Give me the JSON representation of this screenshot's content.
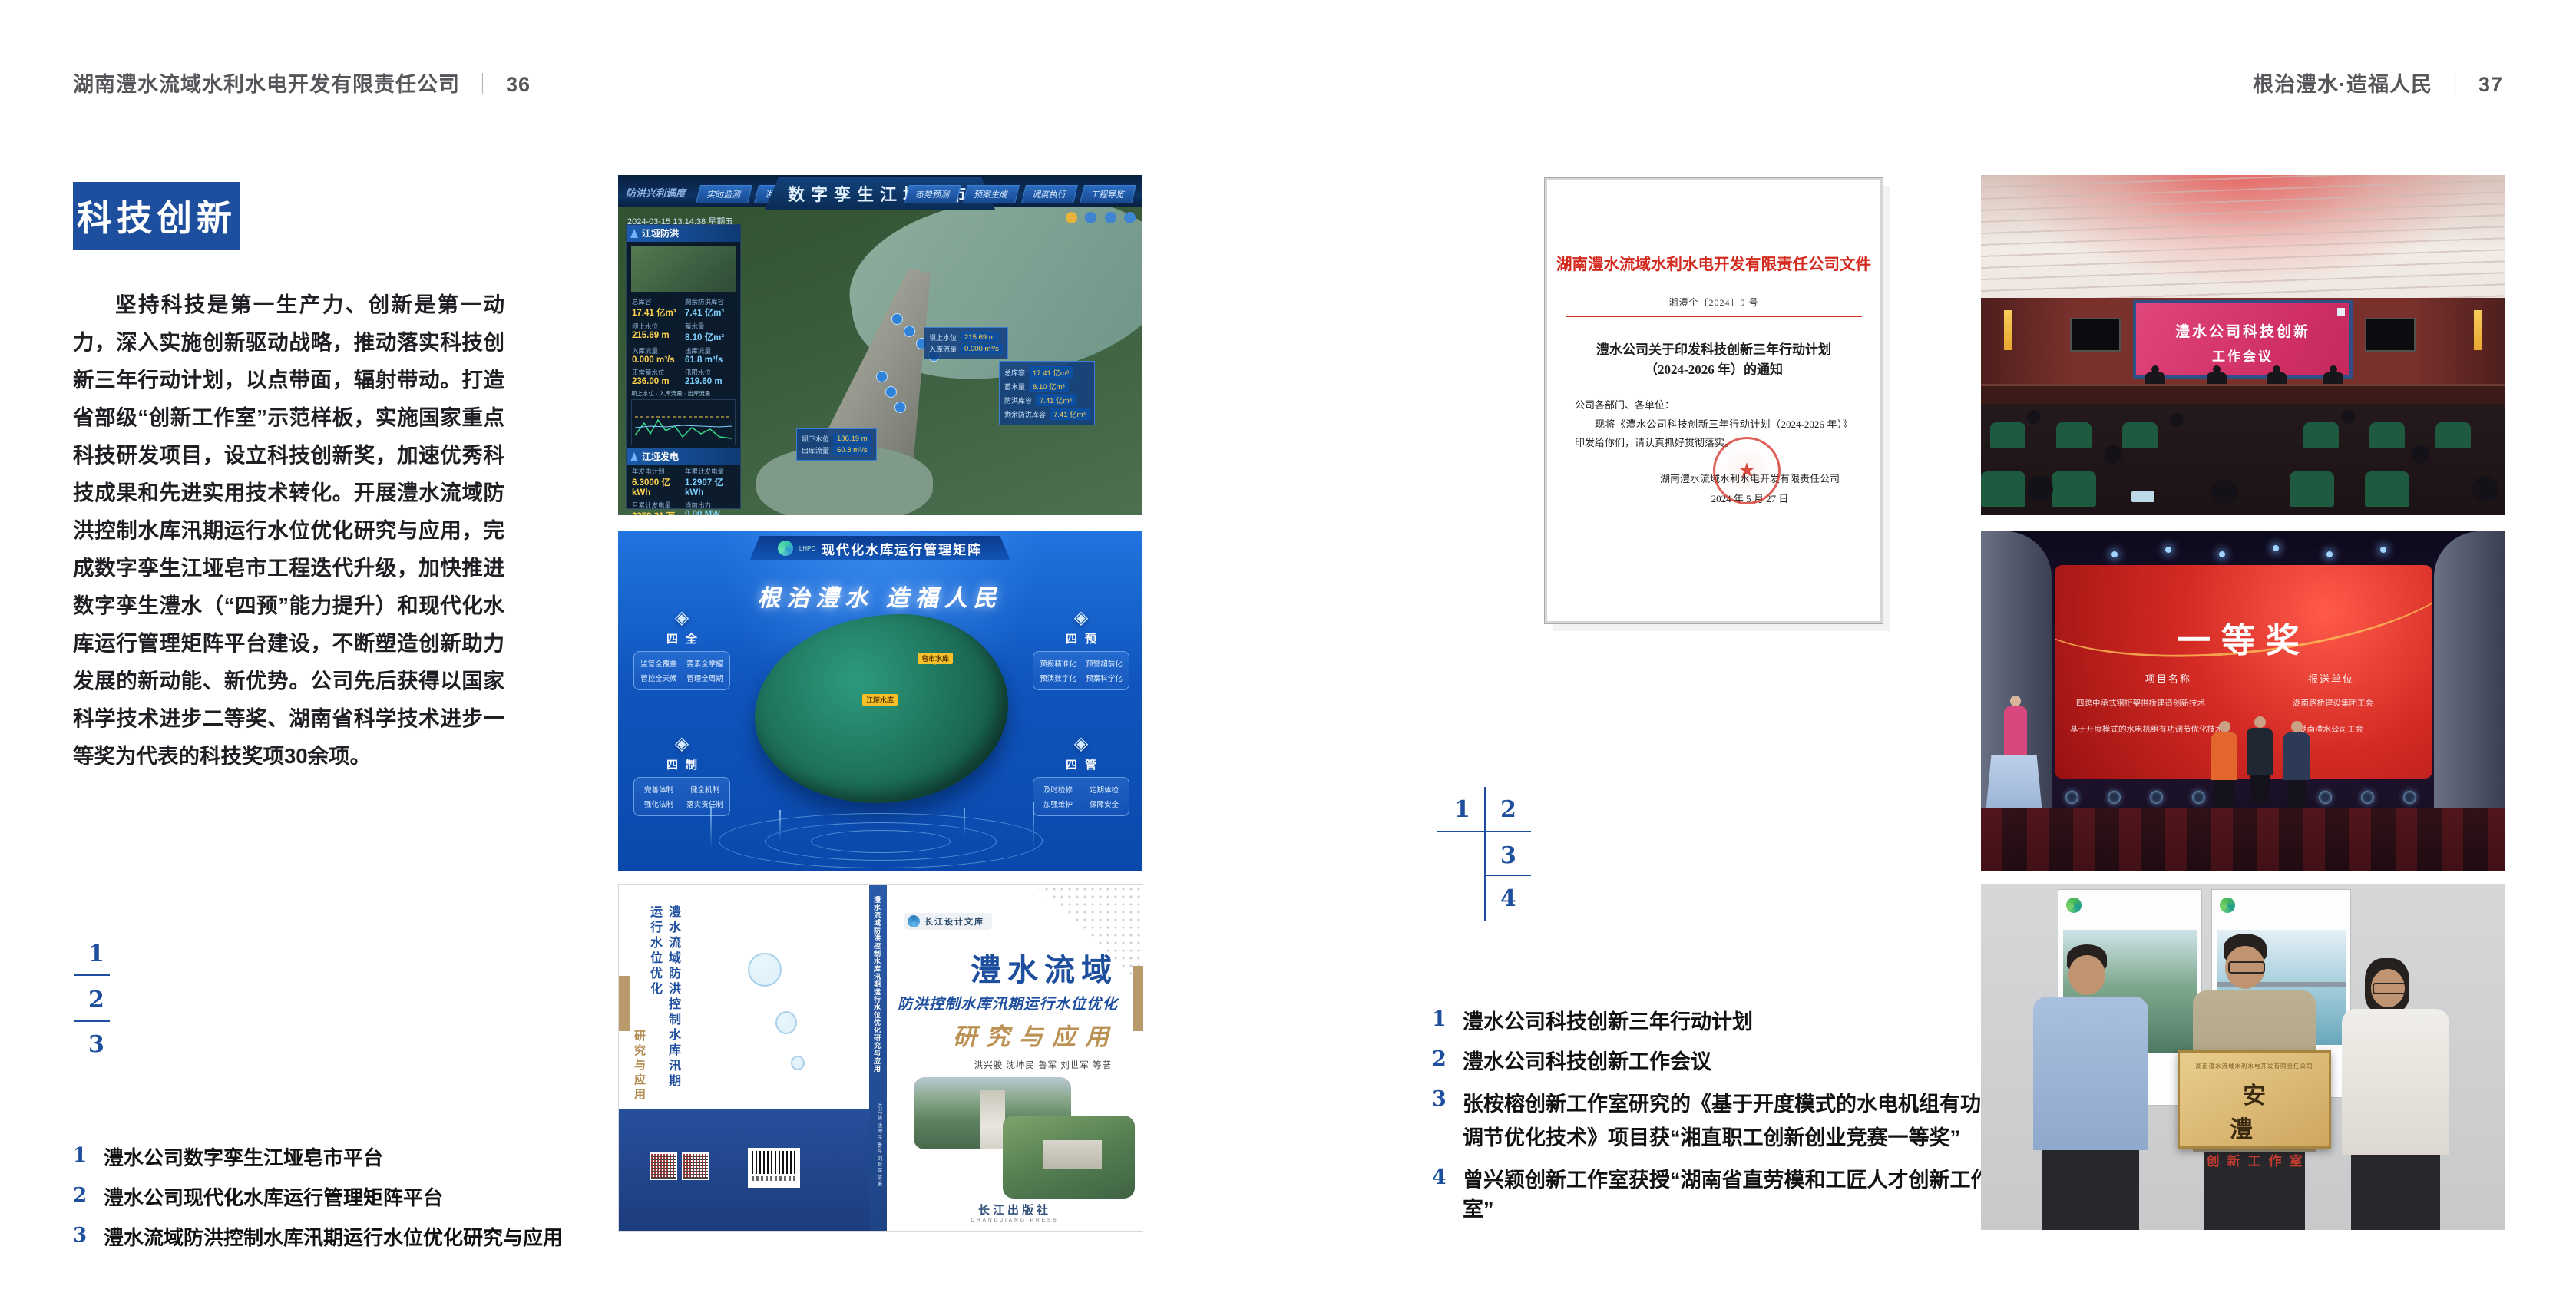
{
  "colors": {
    "accent_blue": "#1e4f9e",
    "doc_red": "#d42b20"
  },
  "page_left": {
    "header_title": "湖南澧水流域水利水电开发有限责任公司",
    "header_sep": "｜",
    "header_page": "36",
    "section_title": "科技创新",
    "body_text": "坚持科技是第一生产力、创新是第一动力，深入实施创新驱动战略，推动落实科技创新三年行动计划，以点带面，辐射带动。打造省部级“创新工作室”示范样板，实施国家重点科技研发项目，设立科技创新奖，加速优秀科技成果和先进实用技术转化。开展澧水流域防洪控制水库汛期运行水位优化研究与应用，完成数字孪生江垭皂市工程迭代升级，加快推进数字孪生澧水（“四预”能力提升）和现代化水库运行管理矩阵平台建设，不断塑造创新助力发展的新动能、新优势。公司先后获得以国家科学技术进步二等奖、湖南省科学技术进步一等奖为代表的科技奖项30余项。",
    "figure_index": [
      "1",
      "2",
      "3"
    ],
    "captions": [
      {
        "num": "1",
        "text": "澧水公司数字孪生江垭皂市平台"
      },
      {
        "num": "2",
        "text": "澧水公司现代化水库运行管理矩阵平台"
      },
      {
        "num": "3",
        "text": "澧水流域防洪控制水库汛期运行水位优化研究与应用"
      }
    ]
  },
  "page_right": {
    "header_title": "根治澧水·造福人民",
    "header_sep": "｜",
    "header_page": "37",
    "figure_index": [
      "1",
      "2",
      "3",
      "4"
    ],
    "captions": [
      {
        "num": "1",
        "text": "澧水公司科技创新三年行动计划"
      },
      {
        "num": "2",
        "text": "澧水公司科技创新工作会议"
      },
      {
        "num": "3",
        "text": "张桉榕创新工作室研究的《基于开度模式的水电机组有功调节优化技术》项目获“湘直职工创新创业竞赛一等奖”"
      },
      {
        "num": "4",
        "text": "曾兴颖创新工作室获授“湖南省直劳模和工匠人才创新工作室”"
      }
    ],
    "document": {
      "org_line": "湖南澧水流域水利水电开发有限责任公司文件",
      "doc_no": "湘澧企〔2024〕9 号",
      "title_line1": "澧水公司关于印发科技创新三年行动计划",
      "title_line2": "（2024-2026 年）的通知",
      "salutation": "公司各部门、各单位：",
      "body": "现将《澧水公司科技创新三年行动计划（2024-2026 年）》印发给你们，请认真抓好贯彻落实。",
      "signature": "湖南澧水流域水利水电开发有限责任公司",
      "date": "2024 年 5 月 27 日",
      "seal_star": "★"
    }
  },
  "dashboard": {
    "corner_label": "防洪兴利调度",
    "title": "数字孪生江垭皂市",
    "tabs_left": [
      "实时监测",
      "洪水预报",
      "防洪预警"
    ],
    "tabs_right": [
      "态势预测",
      "预案生成",
      "调度执行",
      "工程导览"
    ],
    "timestamp": "2024-03-15 13:14:38 星期五",
    "panel_flood": {
      "title": "江垭防洪",
      "legend": "坝上水位 · 入库流量 · 出库流量",
      "stats": [
        {
          "l": "总库容",
          "v": "17.41 亿m³"
        },
        {
          "l": "剩余防洪库容",
          "v": "7.41 亿m³"
        },
        {
          "l": "坝上水位",
          "v": "215.69 m"
        },
        {
          "l": "蓄水量",
          "v": "8.10 亿m³"
        },
        {
          "l": "入库流量",
          "v": "0.000 m³/s"
        },
        {
          "l": "出库流量",
          "v": "61.8 m³/s"
        },
        {
          "l": "正常蓄水位",
          "v": "236.00 m"
        },
        {
          "l": "汛限水位",
          "v": "219.60 m"
        }
      ]
    },
    "panel_power": {
      "title": "江垭发电",
      "stats": [
        {
          "l": "年发电计划",
          "v": "6.3000 亿kWh"
        },
        {
          "l": "年累计发电量",
          "v": "1.2907 亿kWh"
        },
        {
          "l": "月累计发电量",
          "v": "3359.21 万kWh"
        },
        {
          "l": "当前出力",
          "v": "0.00 MW"
        },
        {
          "l": "发电流量",
          "v": "0.00 m³/s"
        },
        {
          "l": "泄水流量",
          "v": "0.00 m³/s"
        }
      ]
    },
    "tooltip_up": {
      "rows": [
        {
          "l": "坝上水位",
          "v": "215.69 m"
        },
        {
          "l": "入库流量",
          "v": "0.000 m³/s"
        }
      ]
    },
    "tooltip_right": {
      "rows": [
        {
          "l": "总库容",
          "v": "17.41 亿m³"
        },
        {
          "l": "蓄水量",
          "v": "8.10 亿m³"
        },
        {
          "l": "防洪库容",
          "v": "7.41 亿m³"
        },
        {
          "l": "剩余防洪库容",
          "v": "7.41 亿m³"
        }
      ]
    },
    "tooltip_down": {
      "rows": [
        {
          "l": "坝下水位",
          "v": "186.19 m"
        },
        {
          "l": "出库流量",
          "v": "60.8 m³/s"
        }
      ]
    }
  },
  "matrix": {
    "logo_abbr": "LHPC",
    "title": "现代化水库运行管理矩阵",
    "slogan": "根治澧水 造福人民",
    "markers": [
      "皂市水库",
      "江垭水库"
    ],
    "panels": [
      {
        "name": "四全",
        "items": [
          "监管全覆盖",
          "要素全掌握",
          "管控全天候",
          "管理全周期"
        ]
      },
      {
        "name": "四制",
        "items": [
          "完善体制",
          "健全机制",
          "强化法制",
          "落实责任制"
        ]
      },
      {
        "name": "四预",
        "items": [
          "预报精准化",
          "预警超前化",
          "预演数字化",
          "预案科学化"
        ]
      },
      {
        "name": "四管",
        "items": [
          "及时检修",
          "定期体检",
          "加强维护",
          "保障安全"
        ]
      }
    ]
  },
  "book": {
    "series": "长江设计文库",
    "title_main": "澧水流域",
    "title_sub": "防洪控制水库汛期运行水位优化",
    "title_tail": "研究与应用",
    "authors": "洪兴骏 沈坤民 鲁军 刘世军 等著",
    "back_title": "澧水流域防洪控制水库汛期运行水位优化",
    "back_tail": "研究与应用",
    "spine_text": "澧水流域防洪控制水库汛期运行水位优化研究与应用",
    "spine_authors": "洪兴骏 沈坤民 鲁军 刘世军 等著",
    "publisher": "长江出版社",
    "publisher_en": "CHANGJIANG PRESS"
  },
  "meeting": {
    "screen_line1": "澧水公司科技创新",
    "screen_line2": "工作会议"
  },
  "award": {
    "title": "一等奖",
    "col_project": "项目名称",
    "col_unit": "报送单位",
    "rows": [
      {
        "project": "四跨中承式钢桁架拱桥建造创新技术",
        "unit": "湖南路桥建设集团工会"
      },
      {
        "project": "基于开度模式的水电机组有功调节优化技术",
        "unit": "湖南澧水公司工会"
      }
    ]
  },
  "group": {
    "plaque_org": "湖南澧水流域水利水电开发有限责任公司",
    "plaque_main": "安 澧",
    "plaque_sub": "创新工作室"
  }
}
